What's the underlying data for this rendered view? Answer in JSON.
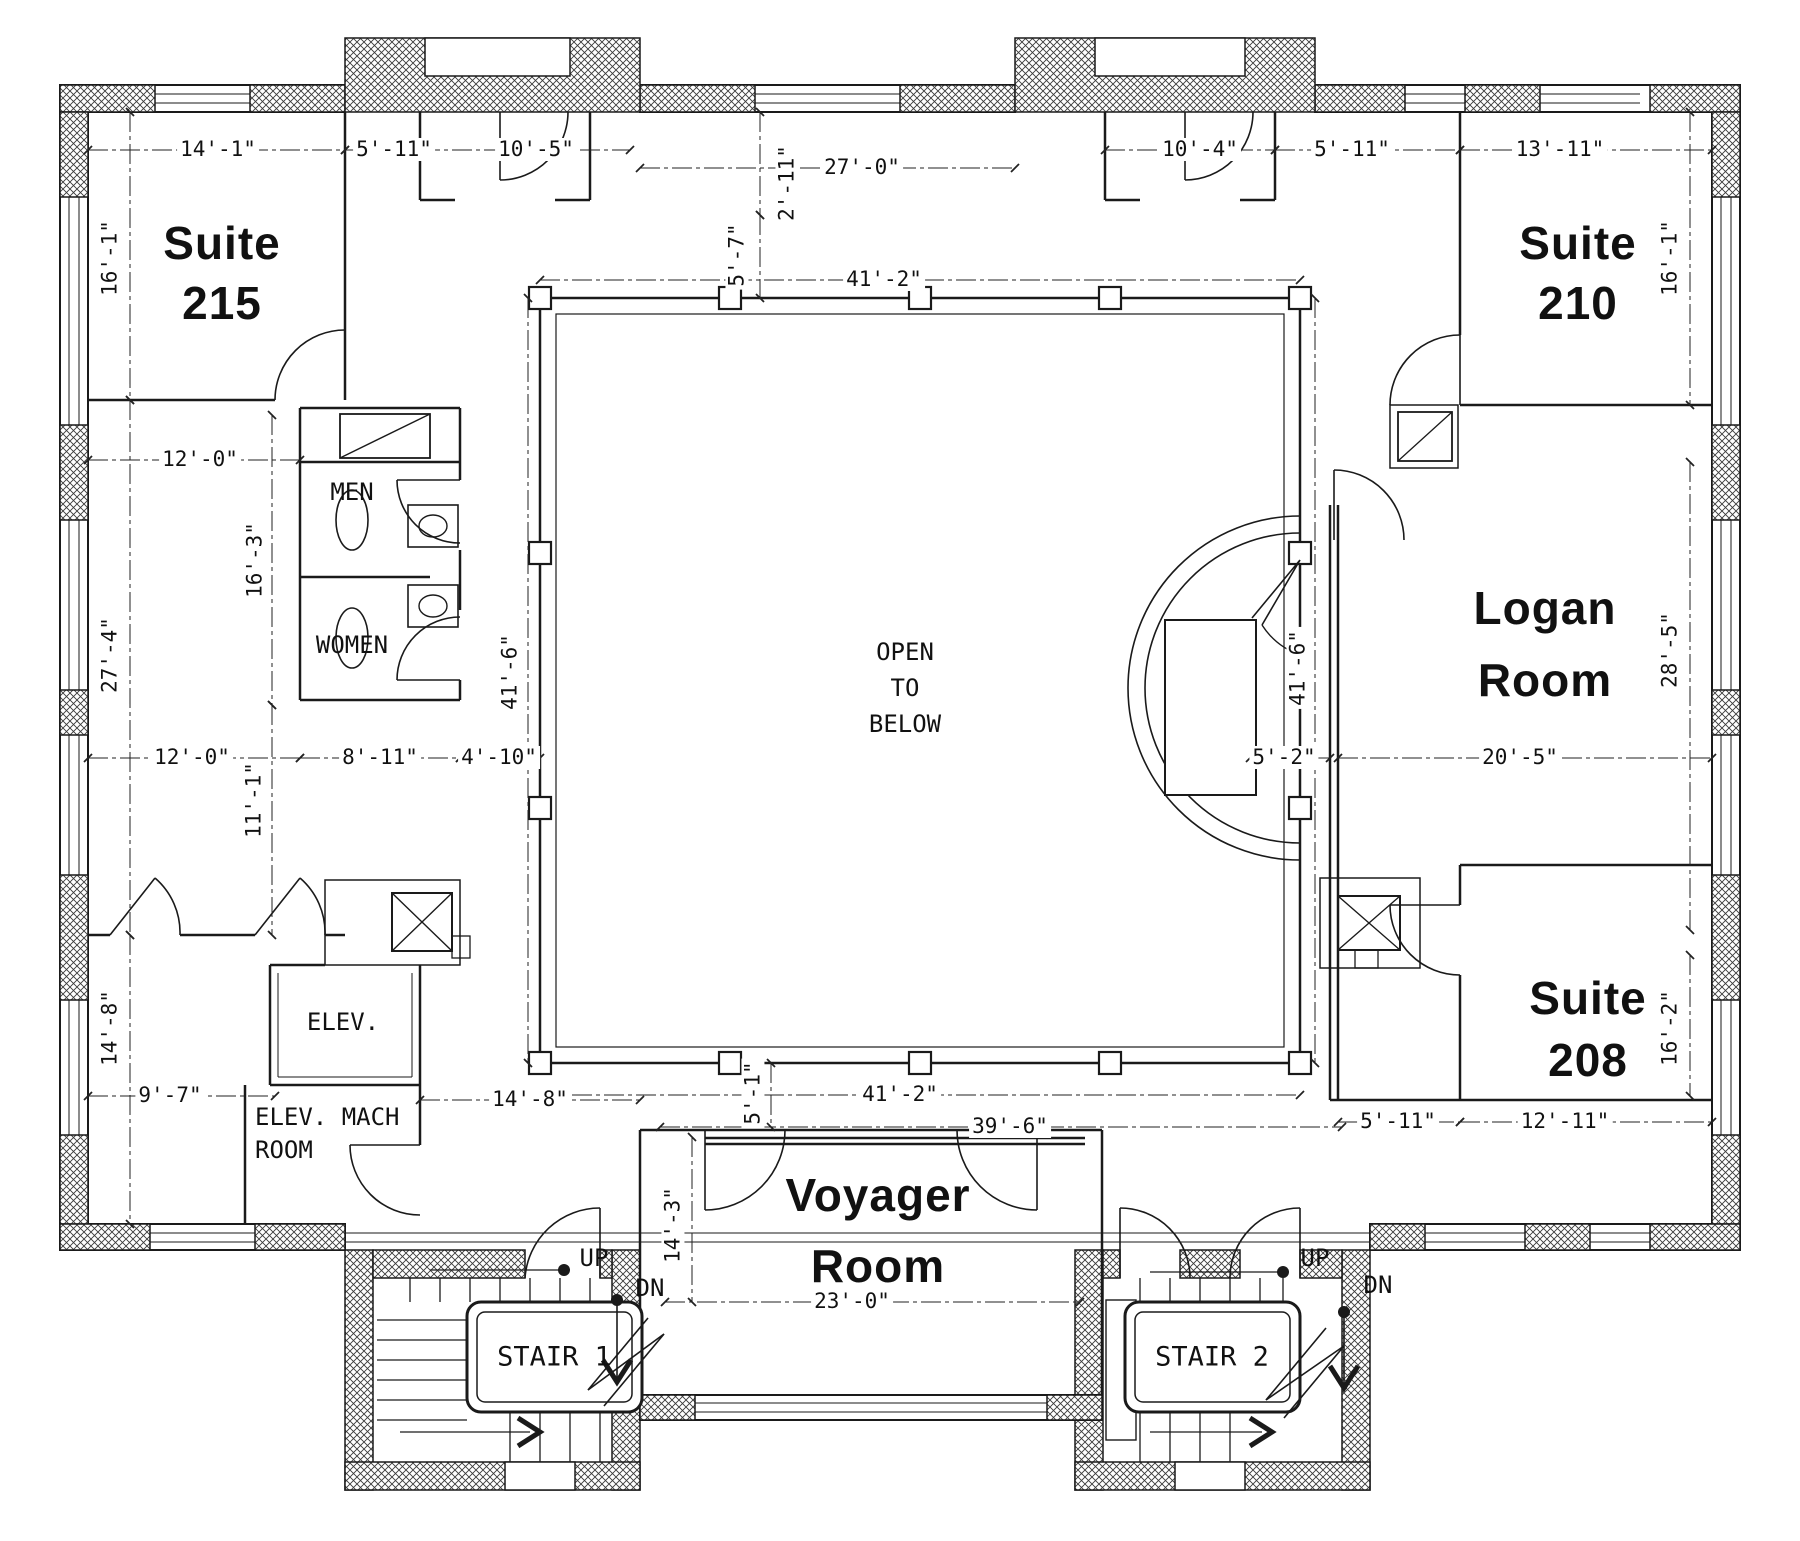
{
  "colors": {
    "ink": "#1a1a1a",
    "dim_text": "#111111",
    "paper": "#ffffff"
  },
  "rooms": {
    "suite215_1": "Suite",
    "suite215_2": "215",
    "suite210_1": "Suite",
    "suite210_2": "210",
    "logan_1": "Logan",
    "logan_2": "Room",
    "suite208_1": "Suite",
    "suite208_2": "208",
    "voyager_1": "Voyager",
    "voyager_2": "Room"
  },
  "labels": {
    "open_1": "OPEN",
    "open_2": "TO",
    "open_3": "BELOW",
    "men": "MEN",
    "women": "WOMEN",
    "elev": "ELEV.",
    "mach_1": "ELEV. MACH",
    "mach_2": "ROOM",
    "stair1": "STAIR 1",
    "stair2": "STAIR 2",
    "up": "UP",
    "dn": "DN"
  },
  "dims": {
    "w14_1": "14'-1\"",
    "w5_11a": "5'-11\"",
    "w10_5": "10'-5\"",
    "w27_0": "27'-0\"",
    "w10_4": "10'-4\"",
    "w5_11b": "5'-11\"",
    "w13_11": "13'-11\"",
    "w2_11": "2'-11\"",
    "w5_7": "5'-7\"",
    "w41_2t": "41'-2\"",
    "h16_1l": "16'-1\"",
    "w12_0a": "12'-0\"",
    "h16_3": "16'-3\"",
    "h27_4": "27'-4\"",
    "h41_6l": "41'-6\"",
    "h41_6r": "41'-6\"",
    "w12_0b": "12'-0\"",
    "w8_11": "8'-11\"",
    "w4_10": "4'-10\"",
    "w5_2": "5'-2\"",
    "w20_5": "20'-5\"",
    "h28_5": "28'-5\"",
    "h16_1r": "16'-1\"",
    "h11_1": "11'-1\"",
    "h14_8l": "14'-8\"",
    "w9_7": "9'-7\"",
    "w14_8": "14'-8\"",
    "w41_2b": "41'-2\"",
    "w39_6": "39'-6\"",
    "h5_1": "5'-1\"",
    "w5_11c": "5'-11\"",
    "w12_11": "12'-11\"",
    "h16_2": "16'-2\"",
    "h14_3": "14'-3\"",
    "w23_0": "23'-0\""
  }
}
